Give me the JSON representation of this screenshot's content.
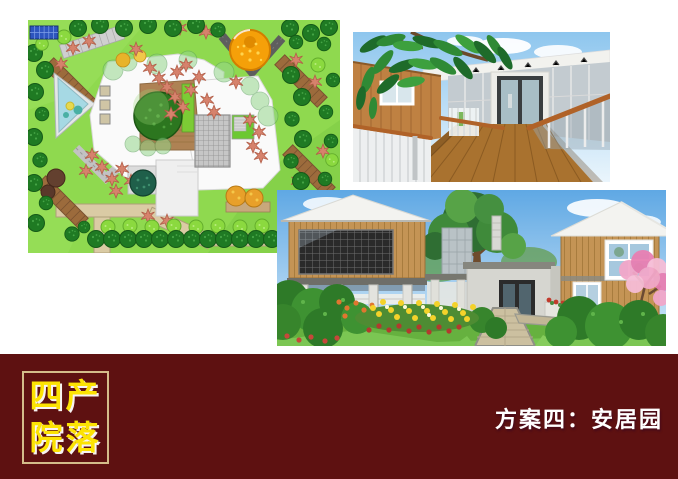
{
  "page": {
    "background_color": "#FFFFFF"
  },
  "banner": {
    "background_color": "#5E1111",
    "badge": {
      "line1": "四产",
      "line2": "院落",
      "text_color": "#FCE303",
      "border_color": "#D4BC8A"
    },
    "plan_title": "方案四：安居园",
    "plan_title_color": "#FFFFFF"
  }
}
